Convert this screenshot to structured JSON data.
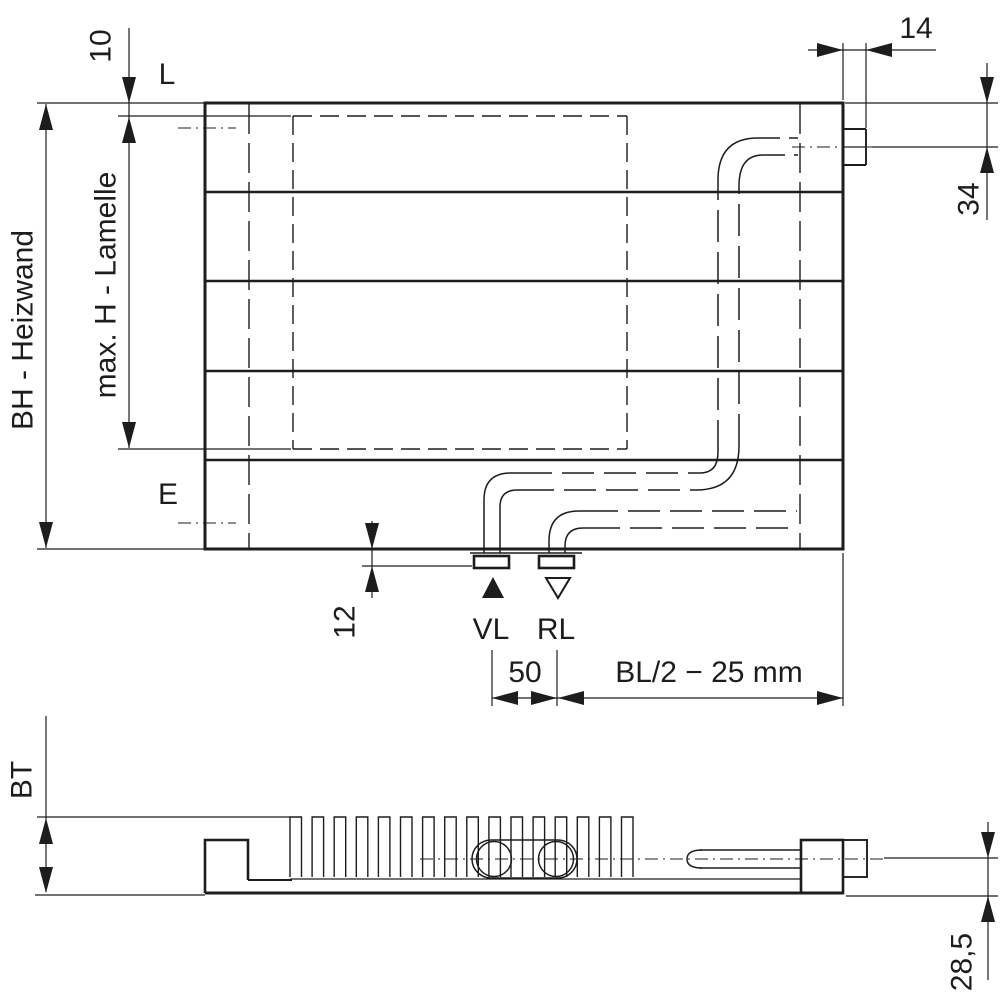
{
  "front_view": {
    "dim_top_offset": "10",
    "label_bracket": "L",
    "dim_height_label": "BH - Heizwand",
    "dim_lamelle_label": "max. H - Lamelle",
    "label_vent": "E",
    "dim_tab_width": "14",
    "dim_tab_offset": "34",
    "dim_connection_depth": "12",
    "label_supply": "VL",
    "label_return": "RL",
    "dim_connection_spacing": "50",
    "dim_connection_position": "BL/2 − 25 mm"
  },
  "bottom_view": {
    "dim_build_depth": "BT",
    "dim_pipe_center_offset": "28,5"
  },
  "colors": {
    "line": "#1d1d1b",
    "background": "#ffffff"
  }
}
